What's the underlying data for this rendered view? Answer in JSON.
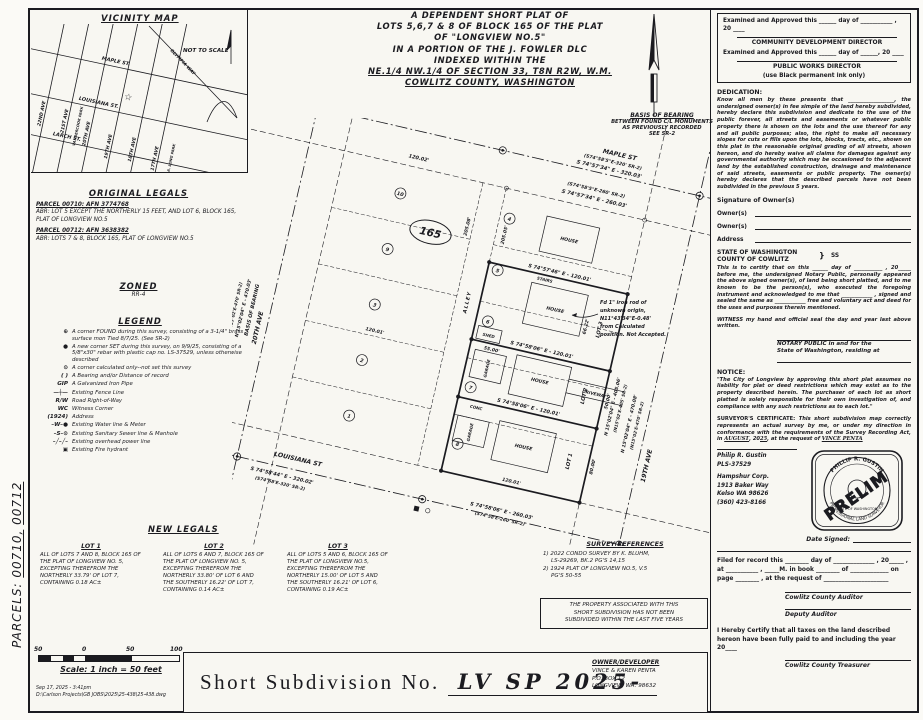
{
  "margin": {
    "label": "PARCELS:",
    "p1": "00710,",
    "p2": "00712"
  },
  "title_block": {
    "l1": "A DEPENDENT SHORT PLAT OF",
    "l2": "LOTS 5,6,7 & 8 OF BLOCK 165 OF THE PLAT",
    "l3": "OF \"LONGVIEW NO.5\"",
    "l4": "IN A PORTION OF THE J. FOWLER DLC",
    "l5": "INDEXED WITHIN THE",
    "l6": "NE.1/4 NW.1/4 OF SECTION 33, T8N R2W, W.M.",
    "l7": "COWLITZ COUNTY, WASHINGTON"
  },
  "vicinity": {
    "title": "VICINITY MAP",
    "nts": "NOT TO SCALE",
    "maple": "MAPLE ST.",
    "louisiana": "LOUISIANA ST.",
    "larch": "LARCH ST.",
    "ave22": "22ND AVE",
    "ave21": "21ST AVE",
    "ave20": "20TH AVE",
    "ave19": "19TH AVE",
    "ave18": "18TH AVE",
    "ave17": "17TH AVE",
    "olympia": "OLYMPIA WAY",
    "park1": "VANDERCOOK PARK",
    "park2": "R.A. LONG PARK",
    "star": "☆"
  },
  "original_legals": {
    "title": "ORIGINAL LEGALS",
    "p1_head": "PARCEL 00710: AFN 3774768",
    "p1_body": "ABR: LOT 5 EXCEPT THE NORTHERLY 15 FEET, AND LOT 6, BLOCK 165, PLAT OF LONGVIEW NO.5",
    "p2_head": "PARCEL 00712: AFN 3638382",
    "p2_body": "ABR: LOTS 7 & 8, BLOCK 165, PLAT OF LONGVIEW NO.5"
  },
  "zoned": {
    "title": "ZONED",
    "value": "RR-4"
  },
  "legend": {
    "title": "LEGEND",
    "items": [
      {
        "sym": "⊕",
        "text": "A corner FOUND during this survey, consisting of a 3-1/4\" brass surface mon Tied 8/7/25. (See SR-2)"
      },
      {
        "sym": "●",
        "text": "A new corner SET during this survey, on 9/9/25, consisting of a 5/8\"x30\" rebar with plastic cap no. LS-37529, unless otherwise described"
      },
      {
        "sym": "⊙",
        "text": "A corner calculated only--not set this survey"
      },
      {
        "sym": "( )",
        "text": "A Bearing and/or Distance of record"
      },
      {
        "sym": "GIP",
        "text": "A Galvanized Iron Pipe"
      },
      {
        "sym": "—┼—",
        "text": "Existing Fence Line"
      },
      {
        "sym": "R/W",
        "text": "Road Right-of-Way"
      },
      {
        "sym": "WC",
        "text": "Witness Corner"
      },
      {
        "sym": "(1924)",
        "text": "Address"
      },
      {
        "sym": "–W–●",
        "text": "Existing Water line & Meter"
      },
      {
        "sym": "–S–⊙",
        "text": "Existing Sanitary Sewer line & Manhole"
      },
      {
        "sym": "–╱–╱–",
        "text": "Existing overhead power line"
      },
      {
        "sym": "▣",
        "text": "Existing Fire hydrant"
      }
    ]
  },
  "new_legals": {
    "title": "NEW LEGALS",
    "lots": [
      {
        "title": "LOT 1",
        "body": "ALL OF LOTS 7 AND 8, BLOCK 165 OF THE PLAT OF LONGVIEW NO. 5, EXCEPTING THEREFROM THE NORTHERLY 33.79' OF LOT 7, CONTAINING 0.18 AC±"
      },
      {
        "title": "LOT 2",
        "body": "ALL OF LOTS 6 AND 7, BLOCK 165 OF THE PLAT OF LONGVIEW NO. 5, EXCEPTING THEREFROM THE NORTHERLY 33.80' OF LOT 6 AND THE SOUTHERLY 16.22' OF LOT 7, CONTAINING 0.14 AC±"
      },
      {
        "title": "LOT 3",
        "body": "ALL OF LOTS 5 AND 6, BLOCK 165 OF THE PLAT OF LONGVIEW NO.5, EXCEPTING THEREFROM THE NORTHERLY 15.00' OF LOT 5 AND THE SOUTHERLY 16.21' OF LOT 6, CONTAINING 0.19 AC±"
      }
    ]
  },
  "survey_refs": {
    "title": "SURVEY REFERENCES",
    "r1a": "1) 2022 CONDO SURVEY BY K. BLUHM,",
    "r1b": "LS-29269, BK.2 PG'S 14,15",
    "r2a": "2) 1924 PLAT OF LONGVIEW NO.5, V.5",
    "r2b": "PG'S 50-55"
  },
  "five_year_note": {
    "l1": "THE PROPERTY ASSOCIATED WITH THIS",
    "l2": "SHORT SUBDIVISION HAS NOT BEEN",
    "l3": "SUBDIVIDED WITHIN THE LAST FIVE YEARS"
  },
  "scalebar": {
    "t50a": "50",
    "t0": "0",
    "t50b": "50",
    "t100": "100",
    "label": "Scale: 1 inch = 50 feet"
  },
  "titlebar": {
    "label": "Short Subdivision No.",
    "number": "LV SP 2025-"
  },
  "owner": {
    "title": "OWNER/DEVELOPER",
    "l1": "VINCE & KAREN PENTA",
    "l2": "P.O. BOX 12",
    "l3": "LONGVIEW, WA. 98632"
  },
  "approvals": {
    "l1": "Examined and Approved this ______ day of ___________ ,",
    "l1b": "20 ____",
    "d1": "COMMUNITY DEVELOPMENT DIRECTOR",
    "l2": "Examined and Approved this ______ day of ______, 20 ____",
    "d2": "PUBLIC WORKS DIRECTOR",
    "ink": "(use Black permanent ink only)"
  },
  "dedication": {
    "title": "DEDICATION:",
    "body": "Know all men by these presents that __________________, the undersigned owner(s) in fee simple of the land hereby subdivided, hereby declare this subdivision and dedicate to the use of the public forever, all streets and easements or whatever public property there is shown on the lots and the use thereof for any and all public purposes; also, the right to make all necessary slopes for cuts or fills upon the lots, blocks, tracts, etc., shown on this plat in the reasonable original grading of all streets, shown hereon, and do hereby waive all claims for damages against any governmental authority which may be occasioned to the adjacent land by the established construction, drainage and maintenance of said streets, easements or public property. The owner(s) hereby declares that the described parcels have not been subdivided in the previous 5 years.",
    "sig_title": "Signature of Owner(s)",
    "owner_label": "Owner(s)",
    "owner_label2": "Owner(s)",
    "address_label": "Address"
  },
  "notary": {
    "state": "STATE OF WASHINGTON",
    "ss": "SS",
    "county": "COUNTY OF COWLITZ",
    "body": "This is to certify that on this ______ day of ___________ , 20_____ before me, the undersigned Notary Public, personally appeared the above signed owner(s), of land being short platted, and to me known to be the person(s), who executed the foregoing instrument and acknowledged to me that ____________ , signed and sealed the same as ____________ free and voluntary act and deed for the uses and purposes therein mentioned.",
    "witness": "WITNESS my hand and official seal the day and year last above written.",
    "pub1": "NOTARY PUBLIC in and for the",
    "pub2": "State of Washington, residing at"
  },
  "notice": {
    "title": "NOTICE:",
    "body": "\"The City of Longview by approving this short plat assumes no liability for plat or deed restrictions which may exist as to the property described herein. The purchaser of each lot as short platted is solely responsible for their own investigation of, and compliance with any such restrictions as to each lot.\""
  },
  "cert": {
    "title": "SURVEYOR'S CERTIFICATE:",
    "b1": "This short subdivision map correctly represents an actual survey by me, or under my direction in conformance with the requirements of the Survey Recording Act, in",
    "month": "AUGUST",
    "b2": ", 20",
    "yr": "25",
    "b3": ", at the request of",
    "requester": "VINCE PENTA"
  },
  "surveyor": {
    "name": "Philip R. Gustin",
    "lic": "PLS-37529",
    "firm": "Hampshur Corp.",
    "a1": "1913 Baker Way",
    "a2": "Kelso WA 98626",
    "phone": "(360) 423-8166"
  },
  "stamp": {
    "name": "PHILLIP R. GUSTIN",
    "state": "STATE OF WASHINGTON",
    "prof": "PROFESSIONAL LAND SURVEYOR",
    "overlay": "PRELIM"
  },
  "dates": {
    "date_signed": "Date Signed:"
  },
  "filed": {
    "body": "Filed for record this ________ day of ______________ , 20_____ , at ___________ , _____M. in book ________ of _____________ on page ________ , at the request of ______________________",
    "auditor": "Cowlitz County Auditor",
    "deputy": "Deputy Auditor",
    "tax": "I Hereby Certify that all taxes on the land described hereon have been fully paid to and including the year 20____",
    "treasurer": "Cowlitz County Treasurer"
  },
  "plat": {
    "maple": "MAPLE ST",
    "maple_rec": "(S74°58'5\"E-320' SR-2)",
    "maple_brg": "S 74°57'34\" E - 320.03'",
    "maple_rec2": "(S74°58'5\"E-260' SR-2)",
    "maple_brg2": "S 74°57'34\" E - 260.03'",
    "d12002": "120.02'",
    "louisiana": "LOUISIANA ST",
    "lou_brg": "S 74°58'06\" E - 260.03'",
    "lou_rec": "(S74°58'E-260' SR-2)",
    "lou_brg2": "S 74°58'44\" E - 320.02'",
    "lou_rec2": "(S74°58'E-320' SR-2)",
    "ave20": "20TH AVE",
    "ave19": "19TH AVE",
    "alley": "ALLEY",
    "basis": "BASIS OF BEARING",
    "basis_brg": "N 15°02'04\" E - 470.03'",
    "basis_rec": "(N15°02'E-470' SR-2)",
    "e_brg1": "N 15°02'04\" E - 405.06'",
    "e_rec1": "(N15°02'E-405' SR-2)",
    "e_brg2": "N 15°02'04\" E - 470.08'",
    "e_rec2": "(N15°02'E-470' SR-2)",
    "block": "165",
    "d205a": "205.08'",
    "d205b": "205.05'",
    "mid_brg1": "S 74°57'46\" E - 120.01'",
    "mid_brg2": "S 74°58'06\" E - 120.01'",
    "mid_brg3": "S 74°58'06\" E - 120.01'",
    "d12001": "120.01'",
    "d12001b": "120.01'",
    "d5500": "55.00'",
    "d5000": "50.00'",
    "d8000": "80.00'",
    "d6622": "66.22'",
    "lot1": "LOT 1",
    "lot2": "LOT 2",
    "lot3": "LOT 3",
    "c_w": [
      "10",
      "9",
      "3",
      "2",
      "1"
    ],
    "c_e": [
      "4",
      "5",
      "6",
      "7",
      "8"
    ],
    "house": "HOUSE",
    "house2": "HOUSE",
    "house3": "HOUSE",
    "house4": "HOUSE",
    "garage": "GARAGE",
    "garage2": "GARAGE",
    "shed": "SHED",
    "driveway": "DRIVEWAY",
    "stairs": "STAIRS",
    "conc": "CONC",
    "iron1": "Fd 1\" iron rod of",
    "iron2": "unknown origin,",
    "iron3": "N11°43'34\"E-0.48'",
    "iron4": "from Calculated",
    "iron5": "position. Not Accepted.",
    "bob1": "BASIS OF BEARING",
    "bob2": "BETWEEN FOUND C/L MONUMENTS",
    "bob3": "AS PREVIOUSLY RECORDED",
    "bob4": "SEE SR-2"
  },
  "footer": {
    "stamp_date": "Sep 17, 2025 - 3:41pm",
    "file": "D:\\Carlson Projects\\GB JOBS\\2025\\25-438\\25-438.dwg"
  }
}
